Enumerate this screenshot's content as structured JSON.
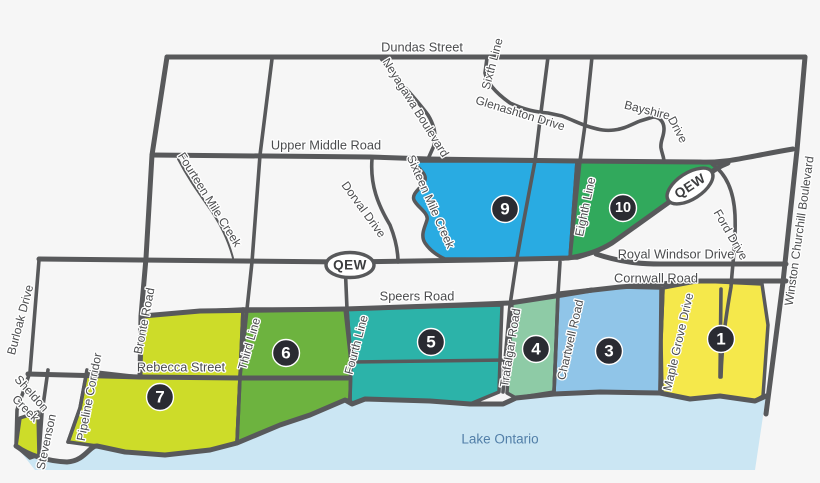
{
  "colors": {
    "background": "#F6F6F6",
    "road": "#58595B",
    "label": "#4B4C4E",
    "halo": "#FFFFFF",
    "lake": "#CBE6F3",
    "lake_label": "#527FA8",
    "badge_bg": "#2A2B32",
    "badge_text": "#FFFFFF"
  },
  "zones": {
    "z1": {
      "number": "1",
      "color": "#F5E84B"
    },
    "z3": {
      "number": "3",
      "color": "#90C5E8"
    },
    "z4": {
      "number": "4",
      "color": "#8ECBA6"
    },
    "z5": {
      "number": "5",
      "color": "#2CB3A9"
    },
    "z6": {
      "number": "6",
      "color": "#6DB33F"
    },
    "z7": {
      "number": "7",
      "color": "#CDDC29"
    },
    "z9": {
      "number": "9",
      "color": "#29ABE2"
    },
    "z10": {
      "number": "10",
      "color": "#31A95C"
    }
  },
  "labels": {
    "dundas": "Dundas Street",
    "sixth": "Sixth Line",
    "neyagawa": "Neyagawa Boulevard",
    "glenashton": "Glenashton Drive",
    "bayshire_word1": "Bayshire",
    "bayshire_word2": "Drive",
    "upper_middle": "Upper Middle Road",
    "fourteen_mile": "Fourteen Mile Creek",
    "dorval": "Dorval Drive",
    "sixteen_mile": "Sixteen Mile Creek",
    "eighth": "Eighth Line",
    "qew": "QEW",
    "ford": "Ford Drive",
    "winston_churchill": "Winston Churchill Boulevard",
    "royal_windsor": "Royal Windsor Drive",
    "cornwall": "Cornwall Road",
    "speers": "Speers Road",
    "burloak": "Burloak Drive",
    "bronte": "Bronte Road",
    "rebecca": "Rebecca Street",
    "pipeline": "Pipeline Corridor",
    "sheldon_word1": "Sheldon",
    "sheldon_word2": "Creek",
    "stevenson": "Stevenson",
    "third": "Third Line",
    "fourth": "Fourth Line",
    "trafalgar": "Trafalgar Road",
    "chartwell": "Chartwell Road",
    "maple_grove": "Maple Grove Drive",
    "lake_ontario": "Lake Ontario"
  }
}
